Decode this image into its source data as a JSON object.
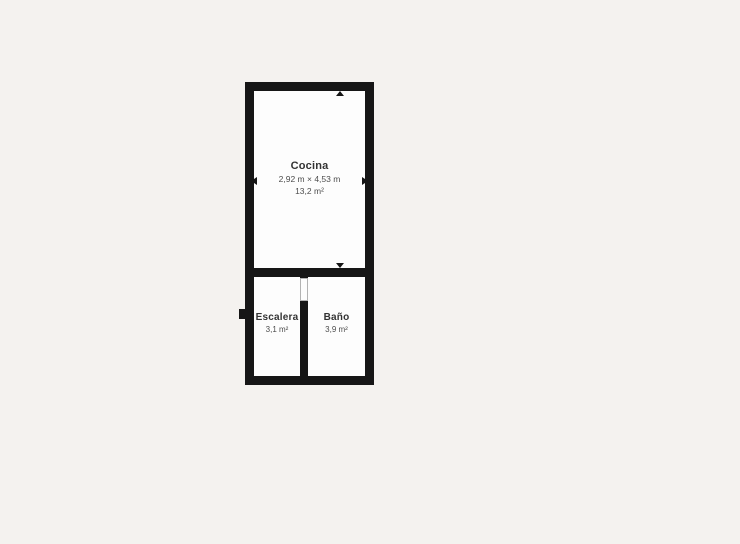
{
  "colors": {
    "background": "#f4f2ef",
    "wall": "#161616",
    "room_fill": "#fdfdfd",
    "door_outline": "#b3b3b3",
    "room_name_text": "#333333",
    "measurement_text": "#4d4d4d"
  },
  "floorplan": {
    "rooms": [
      {
        "id": "cocina",
        "name": "Cocina",
        "dimensions": "2,92 m × 4,53 m",
        "area": "13,2 m²"
      },
      {
        "id": "escalera",
        "name": "Escalera",
        "area": "3,1 m²"
      },
      {
        "id": "bano",
        "name": "Baño",
        "area": "3,9 m²"
      }
    ],
    "icons": [
      "dimension-arrow-up",
      "dimension-arrow-down",
      "dimension-arrow-left",
      "dimension-arrow-right"
    ],
    "features": [
      "door-opening",
      "wall-notch"
    ]
  }
}
